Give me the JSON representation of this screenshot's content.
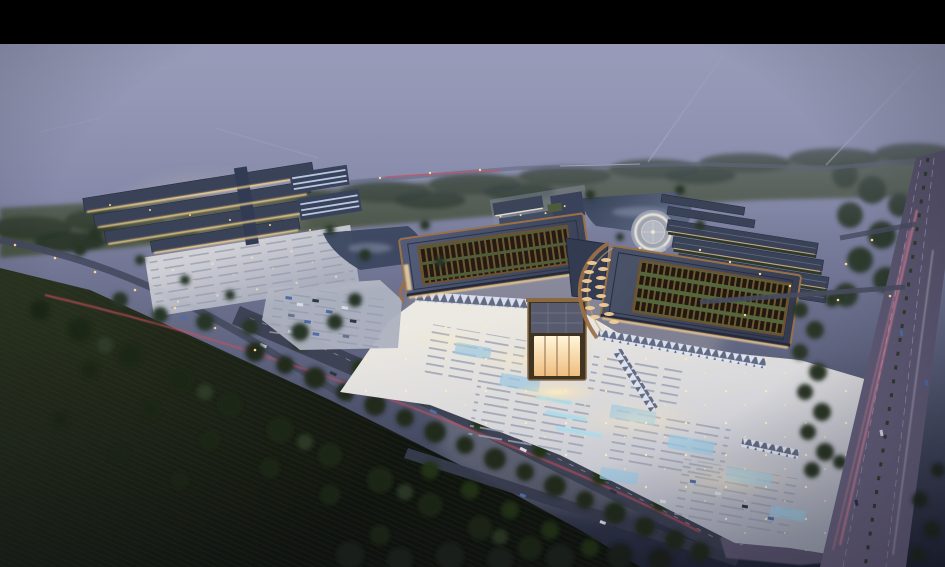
{
  "scene": {
    "kind": "aerial-architectural-rendering",
    "time_of_day": "dusk",
    "visible_text": "",
    "description": "Bird's-eye dusk rendering of a large illuminated complex: two curved-roof halls with lattice skylights and a glowing central gate, bright fountain plaza with parking rows, a western building cluster with parking lot, ponds, circular waterside plaza, eastern row buildings, tree belts, dark farmland, tree-lined boulevard and a highway with light trails. Black letterbox bar across the top."
  },
  "colors": {
    "letterbox": "#000000",
    "haze_top": "#9699b8",
    "haze_mid": "#8286a6",
    "treeline": "#47513f",
    "tree_dark": "#24301f",
    "tree_mid": "#2e3b28",
    "farm_dark": "#11150f",
    "plaza_bright": "#ece9e2",
    "plaza_dim": "#a9adbd",
    "roof_dark": "#3a4258",
    "copper": "#9a7047",
    "lattice_brown": "#6e5632",
    "garden_green": "#55663c",
    "gate_glow": "#ffe9b8",
    "warm_light": "#ffd98f",
    "canopy_light": "#dde3f0",
    "water": "#3b465f",
    "road": "#3c4153",
    "junction": "#665f7c",
    "trail_pink": "#e0849a",
    "trail_red": "#c9505e",
    "fountain_blue": "#a8dcec",
    "glass_blue": "#9cc8e2",
    "car_blue": "#4f6ea6",
    "car_white": "#d7dbe4",
    "stall_line": "#9aa0b4",
    "white_ring": "#f3efdd"
  },
  "elements": {
    "letterbox_top": "black-bar",
    "sky": "purple-dusk-haze",
    "distant_treeline": "hazy-tree-band",
    "west_complex": "building-cluster-with-parking",
    "admin_cluster": "white-roofed-buildings",
    "ponds": "dark-water",
    "circular_plaza": "white-ring-round-plaza",
    "east_rows": "row-buildings",
    "west_hall": "curved-roof-hall-with-skylight",
    "east_hall": "curved-roof-hall-with-oval-lights",
    "entrance_gate": "glowing-central-gate",
    "front_plaza": "lit-plaza-with-parking-and-fountains",
    "boulevard": "tree-lined-road-with-red-light-trail",
    "highway": "multi-lane-road-with-pink-light-trails",
    "farmland": "dark-fields-with-trees"
  }
}
